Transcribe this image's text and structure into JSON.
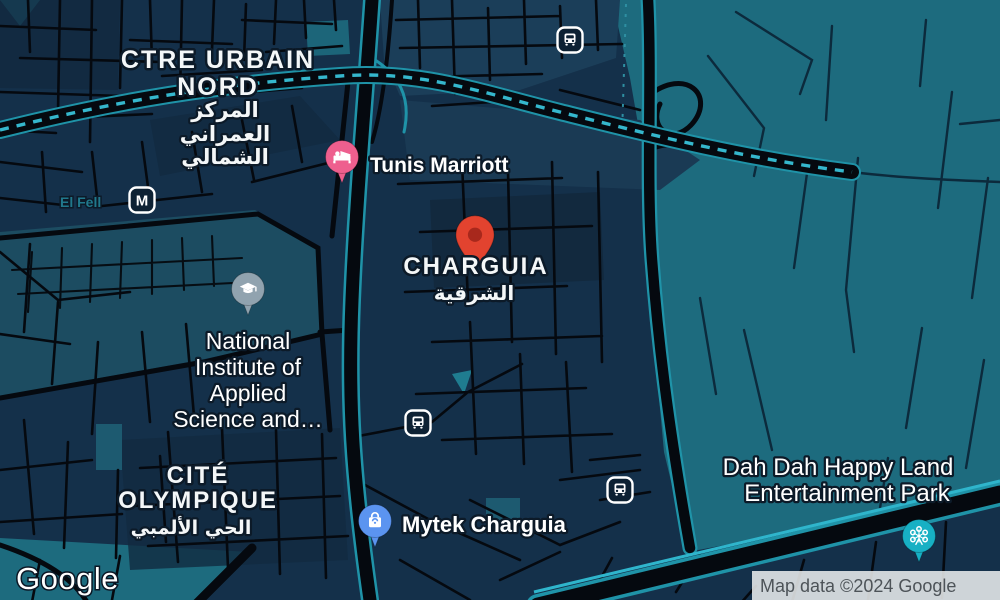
{
  "map": {
    "provider": "google-maps-dark-style",
    "labels": {
      "ctre_urbain_line1": "CTRE URBAIN",
      "ctre_urbain_line2": "NORD",
      "ctre_urbain_ar1": "المركز",
      "ctre_urbain_ar2": "العمراني",
      "ctre_urbain_ar3": "الشمالي",
      "charguia": "CHARGUIA",
      "charguia_ar": "الشرقية",
      "cite_line1": "CITÉ",
      "cite_line2": "OLYMPIQUE",
      "cite_ar": "الحي الألمبي",
      "el_fell": "El Fell",
      "tunis_marriott": "Tunis Marriott",
      "mytek": "Mytek Charguia",
      "nat_line1": "National",
      "nat_line2": "Institute of",
      "nat_line3": "Applied",
      "nat_line4": "Science and…",
      "dahdah_line1": "Dah Dah Happy Land",
      "dahdah_line2": "Entertainment Park",
      "metro_m": "M"
    },
    "markers": [
      {
        "id": "selected-place",
        "kind": "dropped-pin",
        "color": "#E2432F"
      },
      {
        "id": "tunis-marriott",
        "kind": "hotel",
        "label": "Tunis Marriott",
        "icon": "bed-icon",
        "color": "#EE5F8E"
      },
      {
        "id": "national-institute",
        "kind": "university",
        "label": "National Institute of Applied Science and…",
        "icon": "graduation-cap-icon",
        "color": "#91A3AF"
      },
      {
        "id": "mytek-charguia",
        "kind": "store",
        "label": "Mytek Charguia",
        "icon": "shopping-bag-icon",
        "color": "#5B94F0"
      },
      {
        "id": "dah-dah-happy-land",
        "kind": "amusement-park",
        "label": "Dah Dah Happy Land Entertainment Park",
        "icon": "ferris-wheel-icon",
        "color": "#17B0C4"
      }
    ],
    "transit_stations": [
      {
        "kind": "bus"
      },
      {
        "kind": "metro",
        "label": "M",
        "name": "El Fell"
      },
      {
        "kind": "bus"
      },
      {
        "kind": "bus"
      }
    ],
    "colors": {
      "base": "#14304A",
      "teal_area": "#1D6B7E",
      "campus": "#1C4C61",
      "shade_light": "#1B3E59",
      "shade_dark": "#10263A",
      "road": "#05090F",
      "road_casing": "#1F93A8",
      "rail_dash": "#35B7CD",
      "highway_edge": "#2FB5CC",
      "teal_street": "#0C2A3C",
      "label_halo": "#0C1A28",
      "selected_pin": "#E2432F",
      "selected_pin_dot": "#A8281C",
      "hotel_pin": "#EE5F8E",
      "school_pin": "#91A3AF",
      "shop_pin": "#5B94F0",
      "park_pin": "#17B0C4",
      "transit_badge_bg": "#0D2133",
      "station_label": "#20788C",
      "attribution_bg": "#E8EAEC",
      "attribution_text": "#4D5358"
    },
    "footer": {
      "logo_text": "Google",
      "attribution": "Map data ©2024 Google"
    }
  }
}
